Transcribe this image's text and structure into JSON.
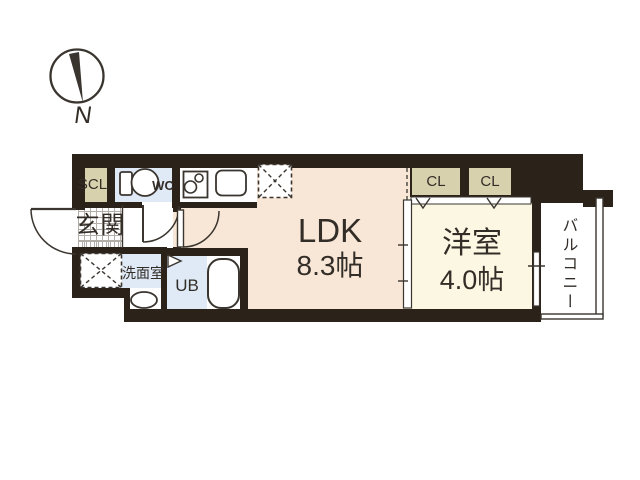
{
  "plan": {
    "compass_label": "N",
    "rooms": {
      "scl": "SCL",
      "wc": "WC",
      "genkan": "玄関",
      "senmen": "洗面室",
      "ub": "UB",
      "ldk_name": "LDK",
      "ldk_size": "8.3帖",
      "yoshitsu_name": "洋室",
      "yoshitsu_size": "4.0帖",
      "cl1": "CL",
      "cl2": "CL",
      "balcony": "バルコニー"
    }
  },
  "colors": {
    "wall": "#2b221a",
    "line": "#3a352f",
    "ink": "#332d28",
    "beige": "#d8d1ad",
    "blue": "#dfeaf6",
    "peach": "#f8e7d6",
    "ivory": "#fbf7e3",
    "hatch": "#b3aea7"
  }
}
